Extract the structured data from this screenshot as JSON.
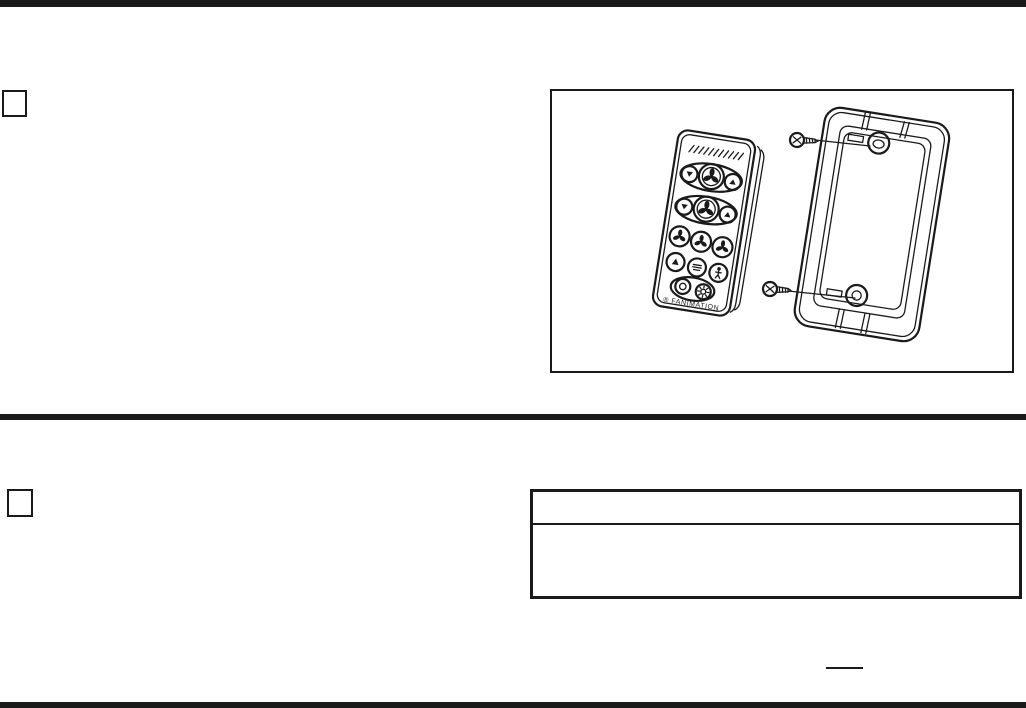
{
  "colors": {
    "ink": "#1a1a1a",
    "paper": "#ffffff"
  },
  "step_boxes": {
    "box1_label": "",
    "box2_label": ""
  },
  "figure": {
    "remote": {
      "brand_label": "® FANIMATION",
      "button_icons": [
        "fan-direction-down-icon",
        "fan-large-icon",
        "fan-direction-up-icon",
        "breeze-down-icon",
        "natural-breeze-icon",
        "timer-icon",
        "fan-speed-low-icon",
        "fan-speed-medium-icon",
        "fan-speed-high-icon",
        "up-arrow-icon",
        "dimmer-icon",
        "walk-away-icon",
        "power-icon",
        "light-icon"
      ]
    },
    "wall_plate": {
      "screw_count": 2
    }
  },
  "notes_table": {
    "header": "",
    "body": ""
  },
  "fill_in_blank": {
    "text": ""
  }
}
